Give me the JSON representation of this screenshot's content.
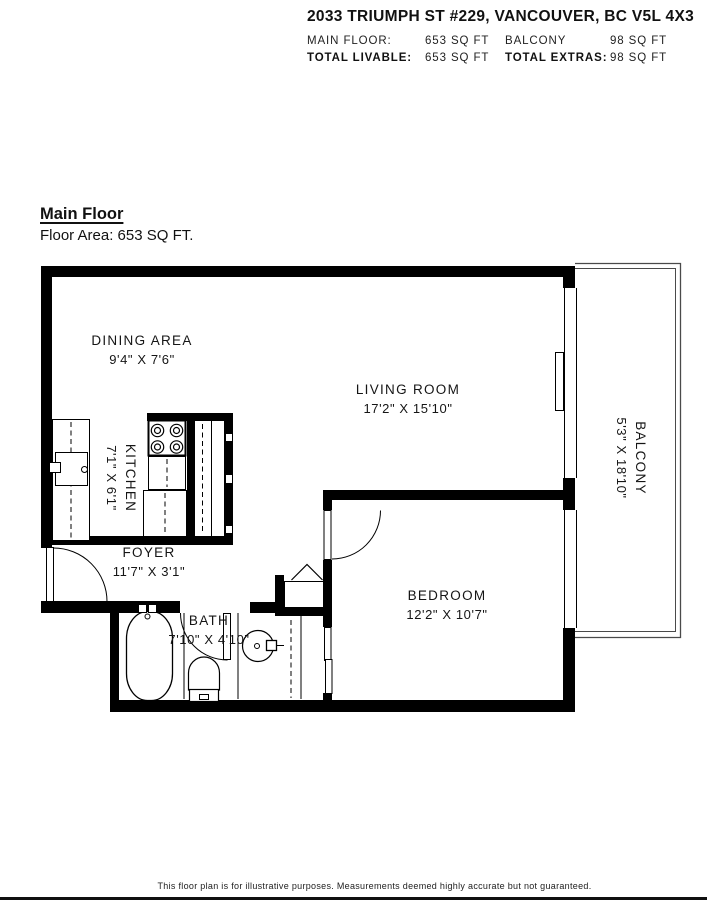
{
  "header": {
    "address": "2033 TRIUMPH ST #229, VANCOUVER, BC V5L 4X3",
    "rows": [
      {
        "label_a": "MAIN FLOOR:",
        "value_a": "653 SQ FT",
        "label_b": "BALCONY",
        "value_b": "98 SQ FT"
      },
      {
        "label_a": "TOTAL LIVABLE:",
        "value_a": "653 SQ FT",
        "label_b": "TOTAL EXTRAS:",
        "value_b": "98 SQ FT"
      }
    ]
  },
  "title": {
    "floor_name": "Main Floor",
    "floor_area": "Floor Area: 653 SQ FT."
  },
  "rooms": {
    "dining": {
      "name": "DINING AREA",
      "dims": "9'4\" X 7'6\""
    },
    "kitchen": {
      "name": "KITCHEN",
      "dims": "7'1\" X 6'1\""
    },
    "living": {
      "name": "LIVING ROOM",
      "dims": "17'2\" X 15'10\""
    },
    "foyer": {
      "name": "FOYER",
      "dims": "11'7\" X 3'1\""
    },
    "bath": {
      "name": "BATH",
      "dims": "7'10\" X 4'10\""
    },
    "bedroom": {
      "name": "BEDROOM",
      "dims": "12'2\" X 10'7\""
    },
    "balcony": {
      "name": "BALCONY",
      "dims": "5'3\" X 18'10\""
    }
  },
  "footer": {
    "disclaimer": "This floor plan is for illustrative purposes. Measurements deemed highly accurate but not guaranteed."
  },
  "colors": {
    "wall": "#000000",
    "fixture_line": "#1a1a1a",
    "balcony_line": "#4a4a4a"
  }
}
